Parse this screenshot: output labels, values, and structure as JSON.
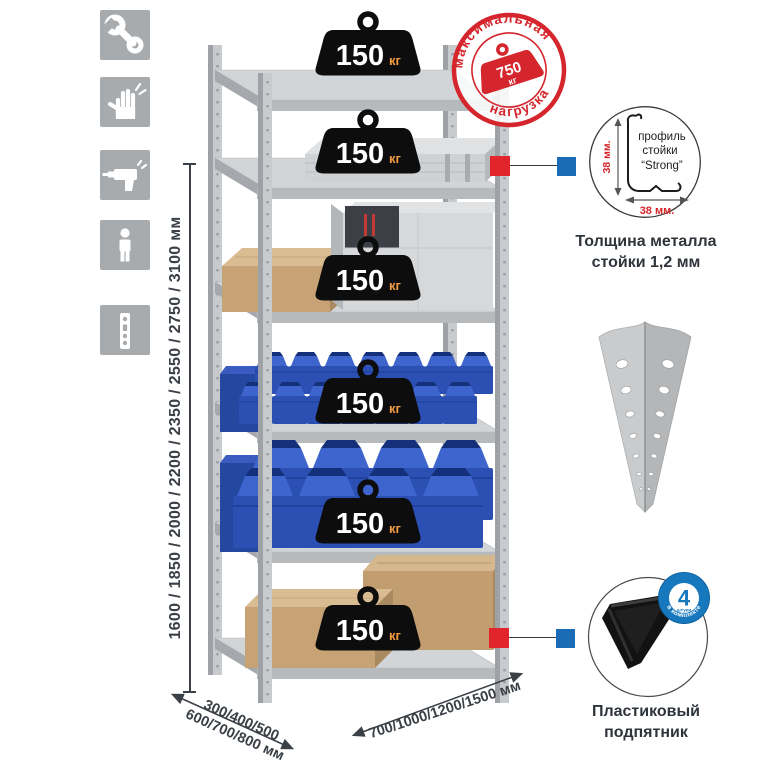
{
  "assembly_icons": {
    "items": [
      {
        "name": "wrench"
      },
      {
        "name": "gloves"
      },
      {
        "name": "drill"
      },
      {
        "name": "person"
      },
      {
        "name": "rack-post-strip"
      }
    ]
  },
  "dimensions": {
    "height_label": "1600 / 1850 / 2000 / 2200 / 2350 / 2550 / 2750 / 3100 мм",
    "depth_line1": "300/400/500",
    "depth_line2": "600/700/800 мм",
    "width_label": "700/1000/1200/1500 мм"
  },
  "shelf_weights": [
    {
      "value": "150",
      "unit": "кг"
    },
    {
      "value": "150",
      "unit": "кг"
    },
    {
      "value": "150",
      "unit": "кг"
    },
    {
      "value": "150",
      "unit": "кг"
    },
    {
      "value": "150",
      "unit": "кг"
    },
    {
      "value": "150",
      "unit": "кг"
    }
  ],
  "max_load_stamp": {
    "arc_top": "максимальная",
    "arc_bottom": "нагрузка",
    "value": "750",
    "unit": "кг"
  },
  "profile_detail": {
    "dim_vertical": "38 мм.",
    "dim_horizontal": "38 мм.",
    "label_line1": "профиль",
    "label_line2": "стойки",
    "label_line3": "“Strong”",
    "caption_line1": "Толщина металла",
    "caption_line2": "стойки 1,2 мм"
  },
  "foot_detail": {
    "badge_value": "4",
    "badge_word": "штуки",
    "badge_arc": "в комплекте",
    "caption_line1": "Пластиковый",
    "caption_line2": "подпятник"
  },
  "colors": {
    "stamp_red": "#d5262d",
    "connector_red": "#e2242b",
    "connector_blue": "#1a6cb7",
    "bin_blue": "#2b4fb2",
    "badge_blue": "#1878be",
    "icon_gray": "#a8abae",
    "weight_black": "#0d0d0d",
    "weight_unit_orange": "#f49b42",
    "dim_text": "#3a4046"
  }
}
